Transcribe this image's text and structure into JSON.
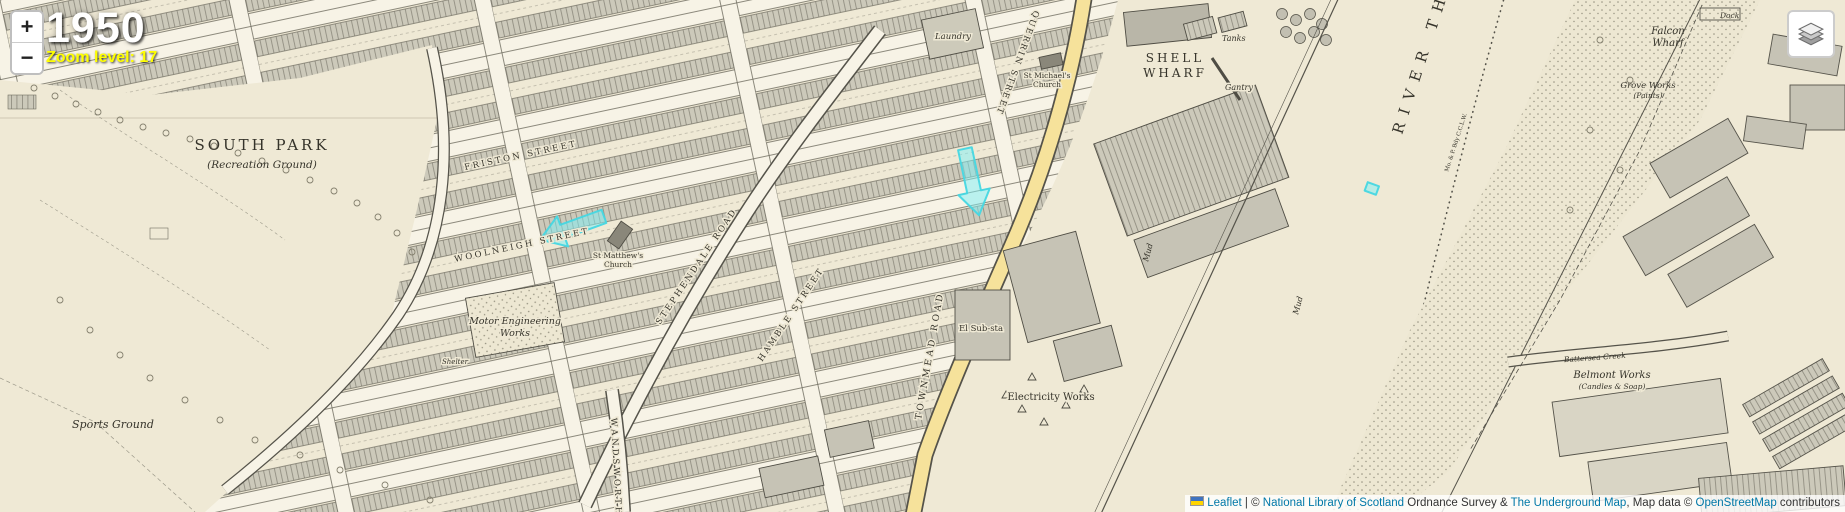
{
  "header": {
    "year": "1950",
    "zoom_level_text": "Zoom level: 17"
  },
  "controls": {
    "zoom_in_label": "+",
    "zoom_out_label": "−"
  },
  "attribution": {
    "leaflet_link": "Leaflet",
    "separator": " | © ",
    "nls_link": "National Library of Scotland",
    "middle_text": " Ordnance Survey & ",
    "underground_link": "The Underground Map",
    "map_data_text": ", Map data © ",
    "osm_link": "OpenStreetMap",
    "contributors_text": " contributors"
  },
  "colors": {
    "paper": "#efe9d5",
    "building_gray": "#c6c3b5",
    "road_yellow": "#f6e29b",
    "highlight_cyan": "#66e8ef",
    "link_blue": "#0078A8",
    "zoom_text_yellow": "#ffff00"
  },
  "map": {
    "labels": {
      "south_park": "SOUTH PARK",
      "south_park_sub": "(Recreation Ground)",
      "sports_ground": "Sports Ground",
      "friston_street": "FRISTON STREET",
      "woolneigh_street": "WOOLNEIGH STREET",
      "querrin_street": "QUERRIN STREET",
      "stephendale_road": "STEPHENDALE ROAD",
      "hamble_street": "HAMBLE STREET",
      "wandsworth": "WANDSWORTH",
      "townmead_road": "TOWNMEAD ROAD",
      "motor_works_1": "Motor Engineering",
      "motor_works_2": "Works",
      "shelter": "Shelter",
      "laundry": "Laundry",
      "st_michaels_1": "St Michael's",
      "st_michaels_2": "Church",
      "st_matthews_1": "St Matthew's",
      "st_matthews_2": "Church",
      "el_substa": "El Sub-sta",
      "electricity_works": "Electricity Works",
      "shell_wharf_1": "SHELL",
      "shell_wharf_2": "WHARF",
      "tanks": "Tanks",
      "gantry": "Gantry",
      "river_thames": "RIVER THAMES",
      "mud_1": "Mud",
      "mud_2": "Mud",
      "boundary_text": "Mo. & P. Bdy  C.C.L.W.",
      "dock": "Dock",
      "falcon_wharf_1": "Falcon",
      "falcon_wharf_2": "Wharf",
      "grove_works_1": "Grove Works",
      "grove_works_2": "(Paints)",
      "belmont_works_1": "Belmont Works",
      "belmont_works_2": "(Candles & Soap)",
      "battersea_creek": "Battersea Creek"
    }
  }
}
